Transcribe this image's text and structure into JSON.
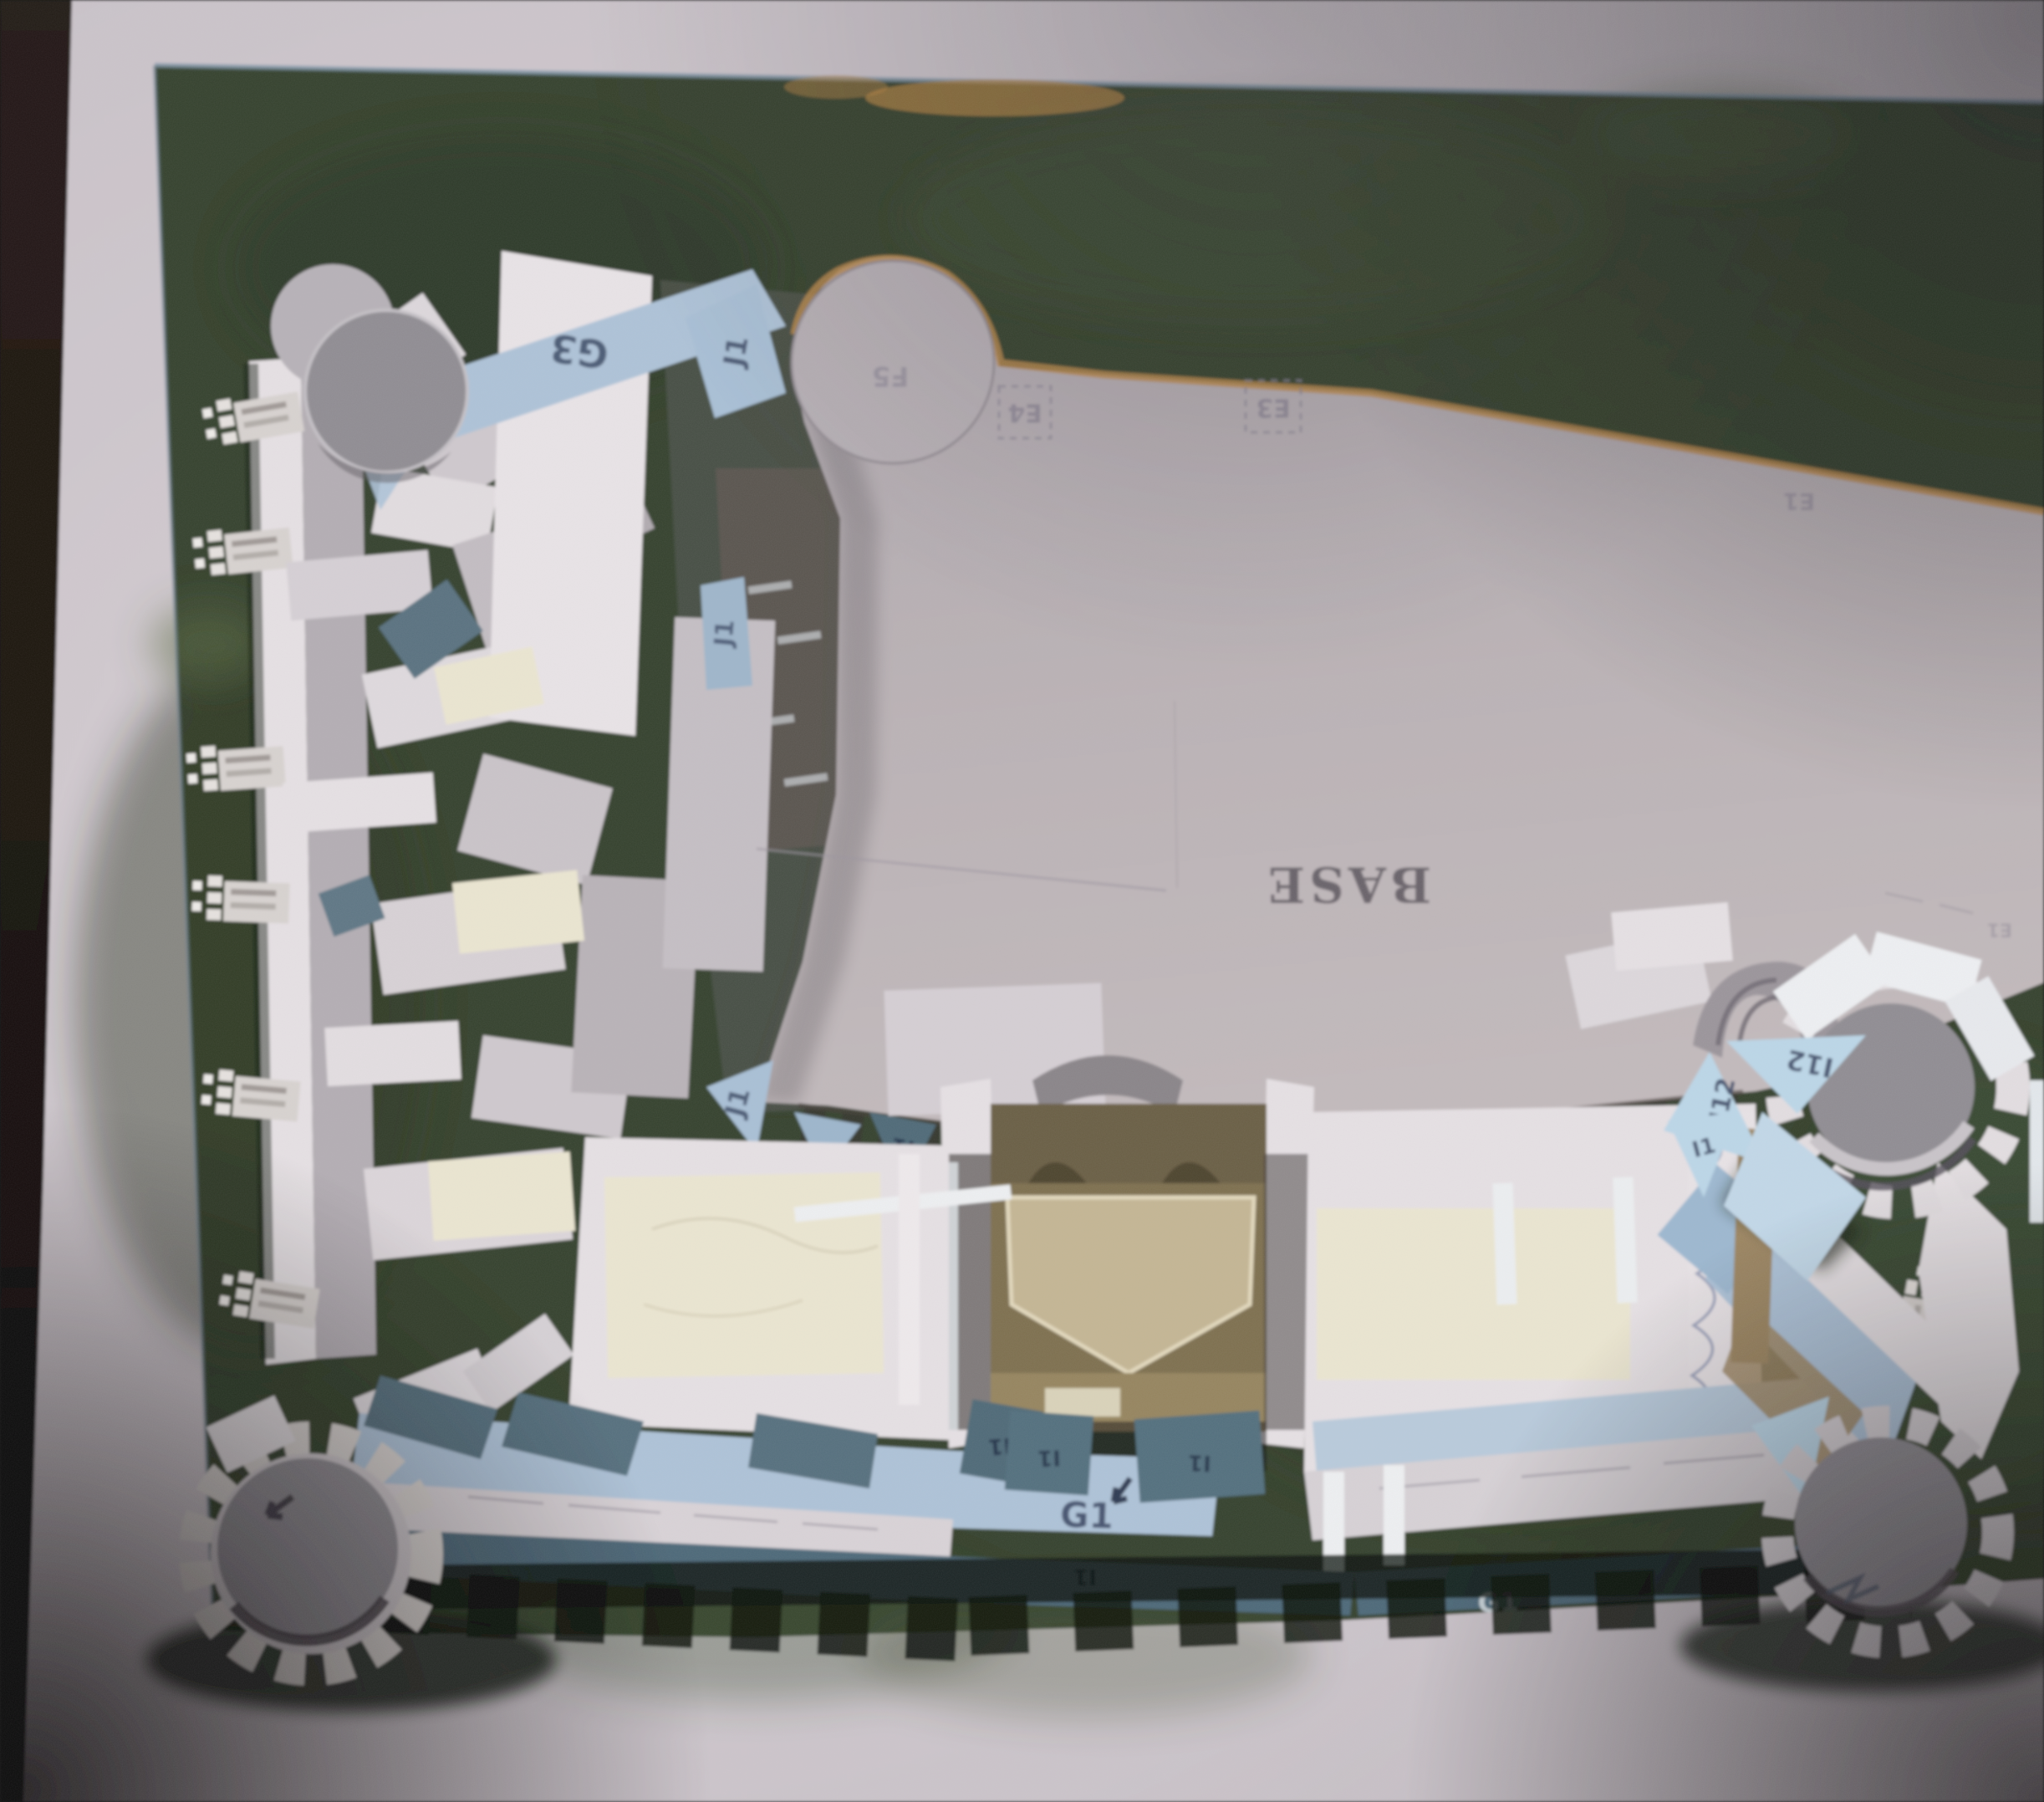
{
  "photo": {
    "part_labels": {
      "base": "BASE",
      "g3": "G3",
      "j1": "J1",
      "e4": "E4",
      "e3": "E3",
      "e1": "E1",
      "f5": "F5",
      "i12": "I12",
      "i1": "I1",
      "g1": "G1"
    },
    "colors": {
      "mat": "#cbc4ca",
      "table_edge": "#1c1410",
      "board_green": "#35422d",
      "board_green_dark": "#25301f",
      "board_green_light": "#4e5f3c",
      "shore_tan": "#bb8a4b",
      "base_sheet": "#b9b1b5",
      "card_white": "#e6e1e4",
      "card_shade": "#b4aeb4",
      "glacis_blue": "#aec3d8",
      "sky_blue_tab": "#bcd7e8",
      "slate_band": "#4e6979",
      "tower_grey": "#908d93",
      "interior_tan": "#96855f",
      "glue_cream": "#ebe6d1",
      "ink_blue": "#3c4a66",
      "pencil_grey": "#8a8494",
      "shadow_dark": "#11180f"
    }
  }
}
